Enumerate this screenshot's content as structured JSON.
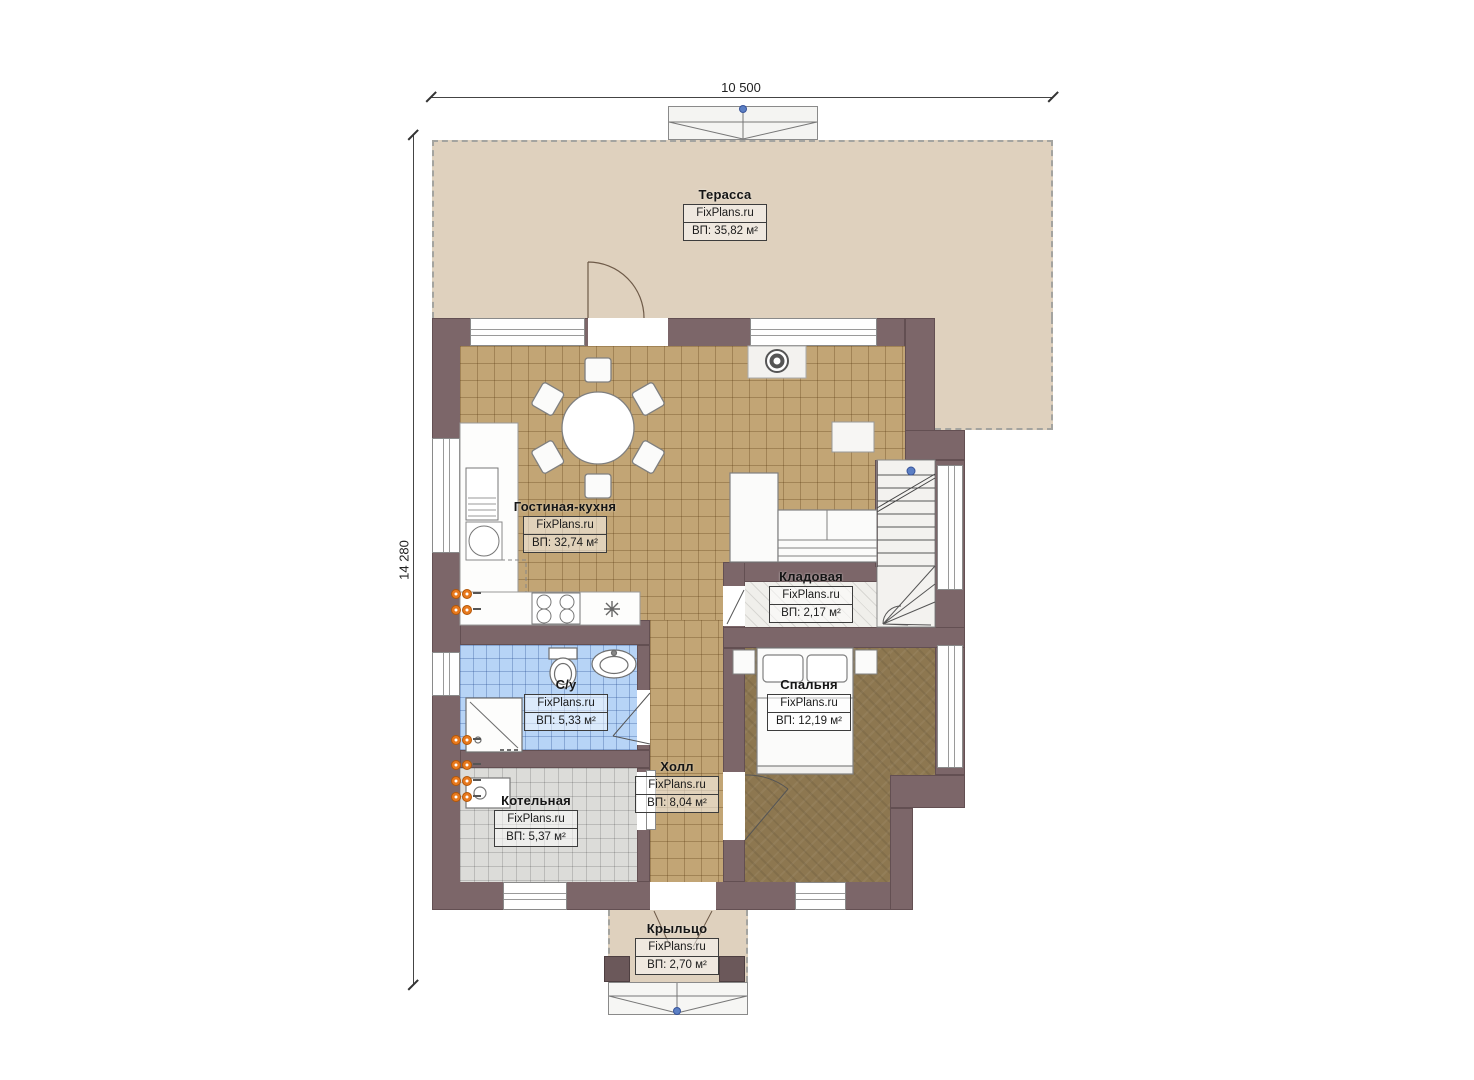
{
  "dimensions": {
    "width_label": "10 500",
    "height_label": "14 280"
  },
  "rooms": [
    {
      "id": "terrace",
      "name": "Терасса",
      "brand": "FixPlans.ru",
      "area": "ВП: 35,82 м²"
    },
    {
      "id": "living-kitchen",
      "name": "Гостиная-кухня",
      "brand": "FixPlans.ru",
      "area": "ВП: 32,74 м²"
    },
    {
      "id": "storage",
      "name": "Кладовая",
      "brand": "FixPlans.ru",
      "area": "ВП: 2,17 м²"
    },
    {
      "id": "bedroom",
      "name": "Спальня",
      "brand": "FixPlans.ru",
      "area": "ВП: 12,19 м²"
    },
    {
      "id": "bathroom",
      "name": "С/у",
      "brand": "FixPlans.ru",
      "area": "ВП: 5,33 м²"
    },
    {
      "id": "hall",
      "name": "Холл",
      "brand": "FixPlans.ru",
      "area": "ВП: 8,04 м²"
    },
    {
      "id": "boiler-room",
      "name": "Котельная",
      "brand": "FixPlans.ru",
      "area": "ВП: 5,37 м²"
    },
    {
      "id": "porch",
      "name": "Крыльцо",
      "brand": "FixPlans.ru",
      "area": "ВП: 2,70 м²"
    }
  ],
  "colors": {
    "wall": "#7c6669",
    "terrace_floor": "#dfd1be",
    "kitchen_tile": "#c2a575",
    "bedroom_floor": "#8d7750",
    "bathroom_tile": "#b7d4f6",
    "boiler_tile": "#dcdcd9",
    "radiator": "#e8791d",
    "marker_blue": "#5b7fc4"
  }
}
